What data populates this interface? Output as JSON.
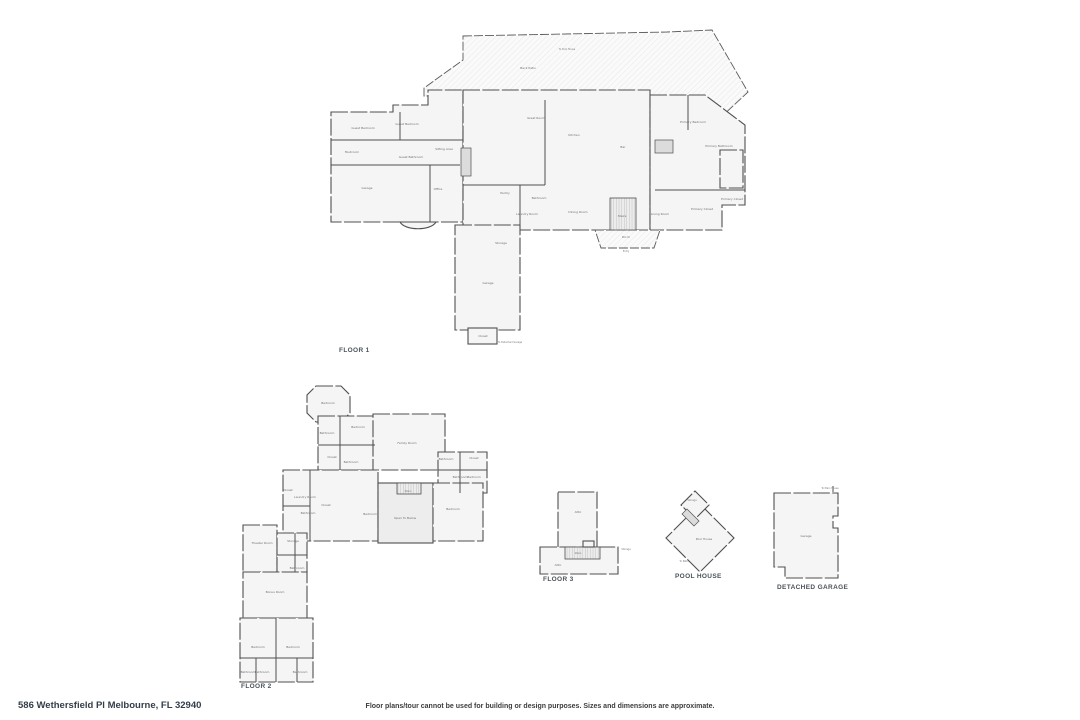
{
  "colors": {
    "wall": "#4f4f4f",
    "floor_fill": "#f5f5f5",
    "hatch_line": "#e2e2e2",
    "open_area_fill": "#ededed",
    "room_label_text": "#6f6f6f",
    "heading_text": "#4a5258",
    "footer_text": "#333e49"
  },
  "plans": {
    "floor1": {
      "heading": "FLOOR 1",
      "rooms": [
        {
          "label": "Back Patio",
          "x": 528,
          "y": 69
        },
        {
          "label": "To Pool House",
          "x": 567,
          "y": 50,
          "s": 1
        },
        {
          "label": "Great Room",
          "x": 536,
          "y": 119
        },
        {
          "label": "Sitting Area",
          "x": 444,
          "y": 150
        },
        {
          "label": "Kitchen",
          "x": 574,
          "y": 136
        },
        {
          "label": "Bar",
          "x": 623,
          "y": 148
        },
        {
          "label": "Primary Bedroom",
          "x": 693,
          "y": 123
        },
        {
          "label": "Primary Bathroom",
          "x": 719,
          "y": 147
        },
        {
          "label": "Primary Closet",
          "x": 702,
          "y": 210
        },
        {
          "label": "Primary Closet",
          "x": 732,
          "y": 200
        },
        {
          "label": "Guest Bedroom",
          "x": 363,
          "y": 129
        },
        {
          "label": "Guest Bedroom",
          "x": 407,
          "y": 125
        },
        {
          "label": "Guest Bathroom",
          "x": 411,
          "y": 158
        },
        {
          "label": "Mudroom",
          "x": 352,
          "y": 153
        },
        {
          "label": "Garage",
          "x": 367,
          "y": 189
        },
        {
          "label": "Office",
          "x": 438,
          "y": 190
        },
        {
          "label": "Dining Room",
          "x": 578,
          "y": 213
        },
        {
          "label": "Stairs",
          "x": 622,
          "y": 217
        },
        {
          "label": "Living Room",
          "x": 660,
          "y": 215
        },
        {
          "label": "Porch",
          "x": 626,
          "y": 238
        },
        {
          "label": "Entry",
          "x": 626,
          "y": 252,
          "s": 1
        },
        {
          "label": "Laundry Room",
          "x": 527,
          "y": 215
        },
        {
          "label": "Bathroom",
          "x": 539,
          "y": 199
        },
        {
          "label": "Pantry",
          "x": 505,
          "y": 194
        },
        {
          "label": "Storage",
          "x": 501,
          "y": 244
        },
        {
          "label": "Garage",
          "x": 488,
          "y": 284
        },
        {
          "label": "Closet",
          "x": 483,
          "y": 337
        },
        {
          "label": "To Detached Garage",
          "x": 510,
          "y": 343,
          "s": 1
        }
      ]
    },
    "floor2": {
      "heading": "FLOOR 2",
      "rooms": [
        {
          "label": "Bedroom",
          "x": 328,
          "y": 404
        },
        {
          "label": "Bathroom",
          "x": 327,
          "y": 434
        },
        {
          "label": "Bedroom",
          "x": 358,
          "y": 428
        },
        {
          "label": "Closet",
          "x": 332,
          "y": 458
        },
        {
          "label": "Bathroom",
          "x": 351,
          "y": 463
        },
        {
          "label": "Family Room",
          "x": 407,
          "y": 444
        },
        {
          "label": "Bathroom",
          "x": 446,
          "y": 460
        },
        {
          "label": "Closet",
          "x": 474,
          "y": 459
        },
        {
          "label": "Bathroom",
          "x": 460,
          "y": 478
        },
        {
          "label": "Bedroom",
          "x": 474,
          "y": 478
        },
        {
          "label": "Closet",
          "x": 288,
          "y": 491
        },
        {
          "label": "Laundry Room",
          "x": 305,
          "y": 498
        },
        {
          "label": "Closet",
          "x": 326,
          "y": 506
        },
        {
          "label": "Bathroom",
          "x": 308,
          "y": 514
        },
        {
          "label": "Bedroom",
          "x": 370,
          "y": 515
        },
        {
          "label": "Stairs",
          "x": 408,
          "y": 492,
          "s": 1
        },
        {
          "label": "Open To Below",
          "x": 405,
          "y": 519
        },
        {
          "label": "Bedroom",
          "x": 453,
          "y": 510
        },
        {
          "label": "Theater Room",
          "x": 262,
          "y": 544
        },
        {
          "label": "Storage",
          "x": 293,
          "y": 542
        },
        {
          "label": "Bathroom",
          "x": 297,
          "y": 569
        },
        {
          "label": "Bonus Room",
          "x": 275,
          "y": 593
        },
        {
          "label": "Bedroom",
          "x": 258,
          "y": 648
        },
        {
          "label": "Bedroom",
          "x": 293,
          "y": 648
        },
        {
          "label": "Bathroom",
          "x": 248,
          "y": 673
        },
        {
          "label": "Bathroom",
          "x": 262,
          "y": 673
        },
        {
          "label": "Bathroom",
          "x": 300,
          "y": 673
        }
      ]
    },
    "floor3": {
      "heading": "FLOOR 3",
      "rooms": [
        {
          "label": "Attic",
          "x": 578,
          "y": 513
        },
        {
          "label": "Stairs",
          "x": 578,
          "y": 554,
          "s": 1
        },
        {
          "label": "Attic",
          "x": 558,
          "y": 566
        },
        {
          "label": "Storage",
          "x": 626,
          "y": 550,
          "s": 1
        }
      ]
    },
    "pool_house": {
      "heading": "POOL HOUSE",
      "rooms": [
        {
          "label": "Storage",
          "x": 692,
          "y": 501,
          "s": 1
        },
        {
          "label": "Pool House",
          "x": 704,
          "y": 540
        },
        {
          "label": "To Patio",
          "x": 684,
          "y": 562,
          "s": 1
        }
      ]
    },
    "detached_garage": {
      "heading": "DETACHED GARAGE",
      "rooms": [
        {
          "label": "To Main House",
          "x": 830,
          "y": 489,
          "s": 1
        },
        {
          "label": "Garage",
          "x": 806,
          "y": 537
        }
      ]
    }
  },
  "footer": {
    "address": "586 Wethersfield Pl Melbourne, FL 32940",
    "disclaimer": "Floor plans/tour cannot be used for building or design purposes. Sizes and dimensions are approximate."
  }
}
